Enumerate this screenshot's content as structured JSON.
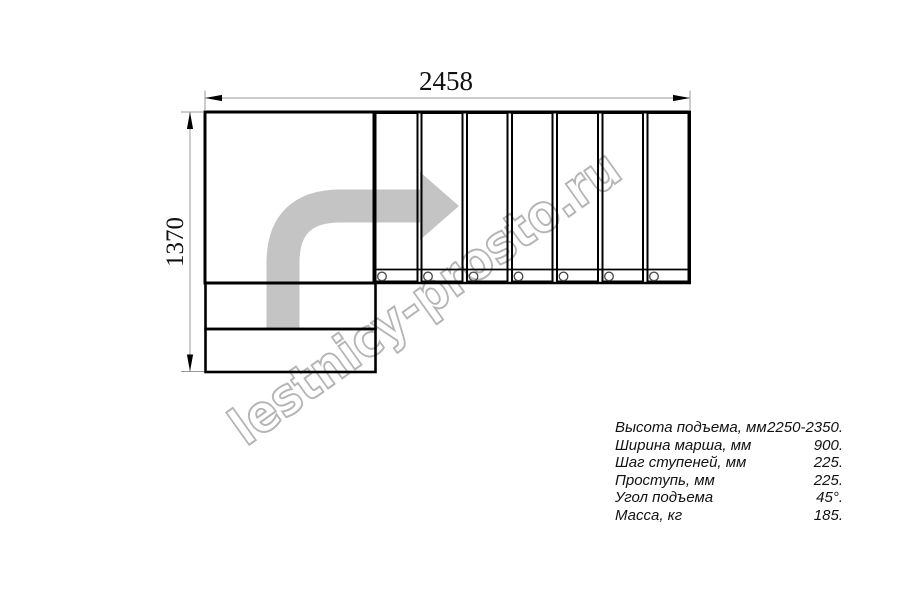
{
  "drawing": {
    "dimension_width_mm": "2458",
    "dimension_height_mm": "1370"
  },
  "watermark": {
    "text": "lestnicy-prosto.ru"
  },
  "specs": {
    "rows": [
      {
        "label": "Высота подъема, мм",
        "value": "2250-2350."
      },
      {
        "label": "Ширина марша, мм",
        "value": "900."
      },
      {
        "label": "Шаг ступеней, мм",
        "value": "225."
      },
      {
        "label": "Проступь, мм",
        "value": "225."
      },
      {
        "label": "Угол подъема",
        "value": "45°."
      },
      {
        "label": "Масса, кг",
        "value": "185."
      }
    ]
  },
  "colors": {
    "line": "#000000",
    "dimension_line": "#999999",
    "arrow_fill": "#c4c4c4",
    "watermark_stroke": "#b5b5b5",
    "text": "#111111"
  }
}
